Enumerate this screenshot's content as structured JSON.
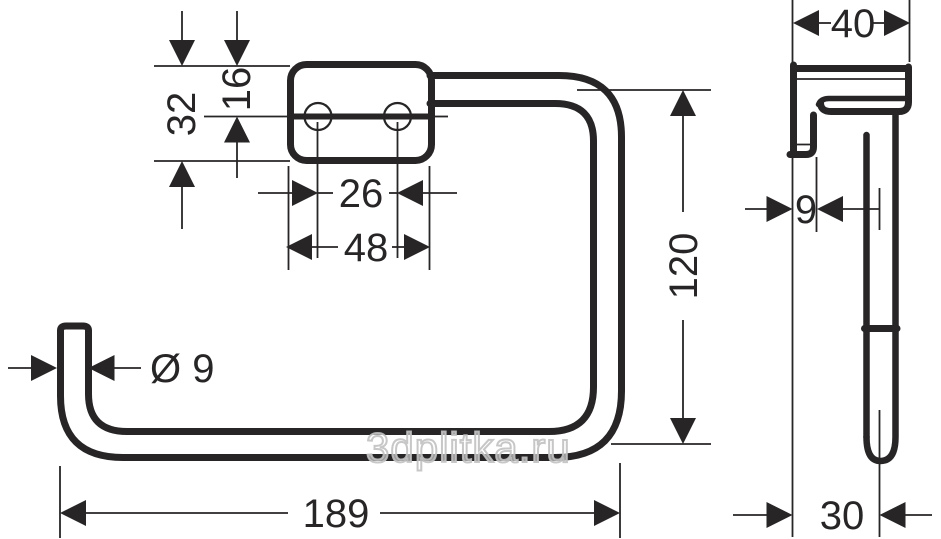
{
  "watermark": "3dplitka.ru",
  "colors": {
    "line": "#272525",
    "watermark": "#c1c1c1",
    "background": "#ffffff"
  },
  "views": {
    "front": {
      "plate_height_mm": "32",
      "plate_top_to_hole_mm": "16",
      "hole_spacing_mm": "26",
      "plate_width_mm": "48",
      "tube_diameter_label": "Ø 9",
      "overall_width_mm": "189",
      "overall_height_mm": "120"
    },
    "side": {
      "depth_mm": "40",
      "wall_plate_depth_mm": "9",
      "wall_to_tube_center_mm": "30"
    }
  }
}
